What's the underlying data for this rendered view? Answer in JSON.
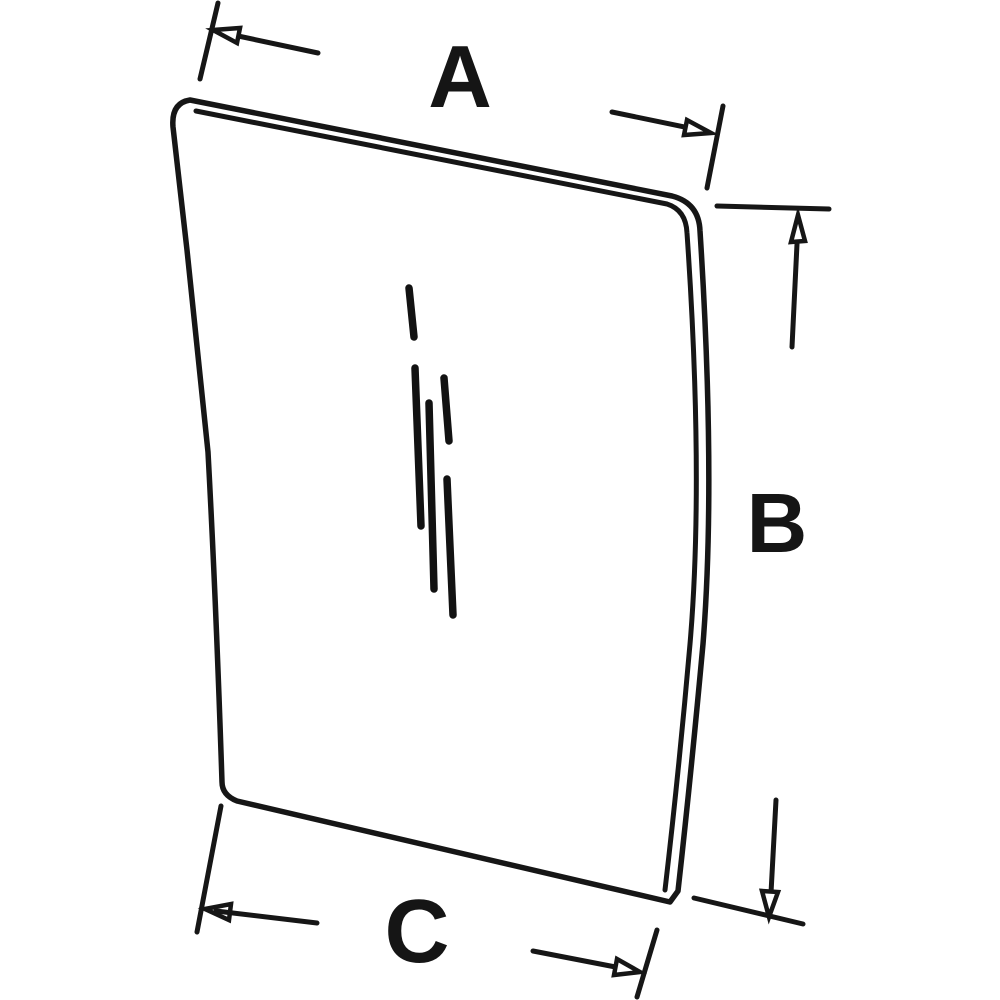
{
  "diagram": {
    "subject": "trapezoidal glass panel technical line drawing with dimension callouts",
    "background_color": "#ffffff",
    "line_color": "#161616",
    "dimension_labels": {
      "a": "A",
      "b": "B",
      "c": "C"
    }
  }
}
